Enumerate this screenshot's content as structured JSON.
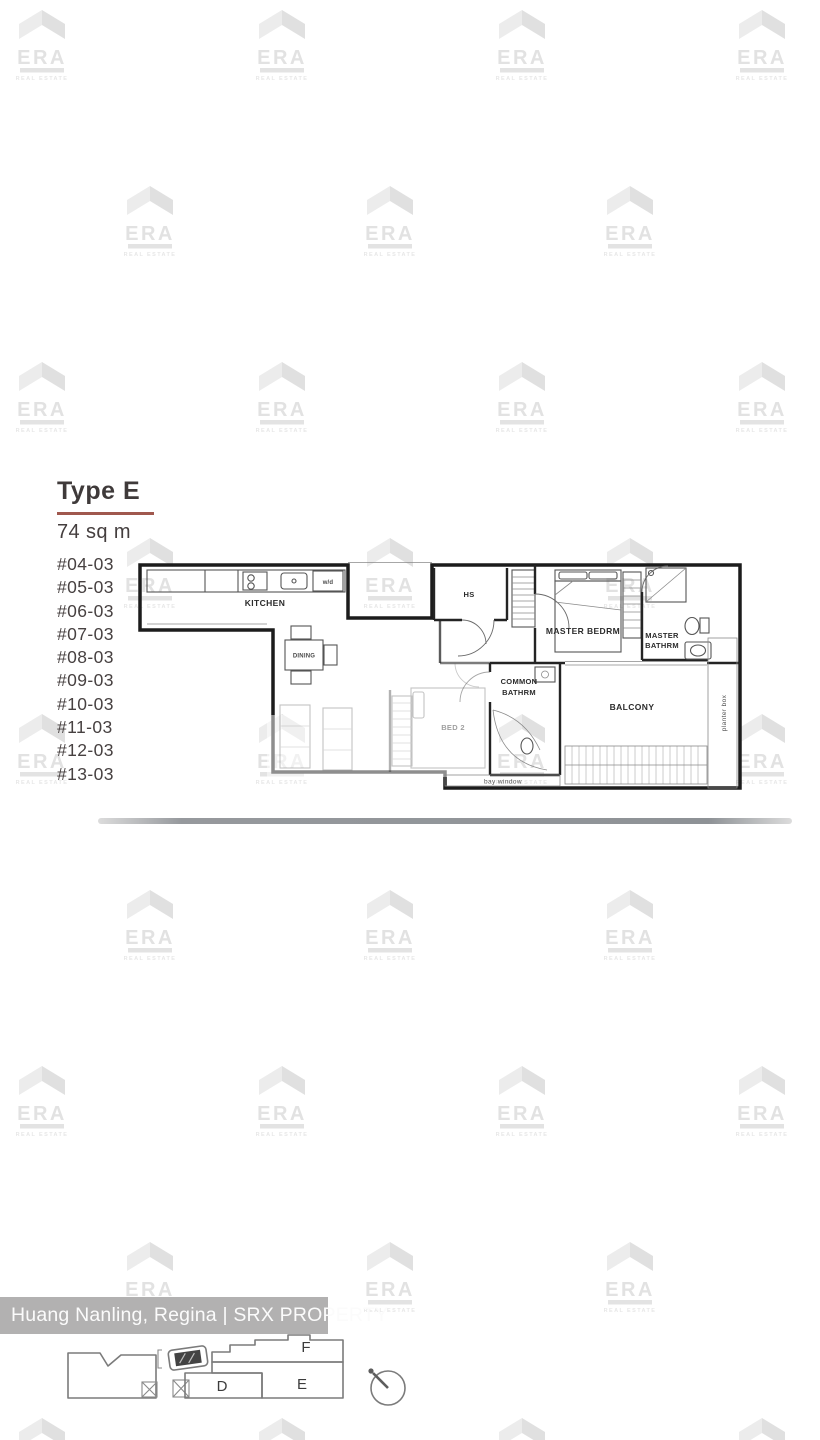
{
  "header": {
    "type_label": "Type E",
    "area": "74 sq m"
  },
  "units": [
    "#04-03",
    "#05-03",
    "#06-03",
    "#07-03",
    "#08-03",
    "#09-03",
    "#10-03",
    "#11-03",
    "#12-03",
    "#13-03"
  ],
  "floor_plan": {
    "labels": {
      "kitchen": "KITCHEN",
      "dining": "DINING",
      "household_shelter": "HS",
      "master_bedroom": "MASTER BEDRM",
      "master_bathroom_line1": "MASTER",
      "master_bathroom_line2": "BATHRM",
      "common_bathroom_line1": "COMMON",
      "common_bathroom_line2": "BATHRM",
      "balcony": "BALCONY",
      "bedroom2": "BED 2",
      "planter_box": "planter box",
      "bay_window": "bay window",
      "washer_dryer": "w/d"
    }
  },
  "watermark": {
    "brand": "ERA",
    "subtext": "REAL ESTATE"
  },
  "attribution": {
    "text": "Huang Nanling, Regina | SRX PROPERTY"
  },
  "site_plan": {
    "block_d": "D",
    "block_e": "E",
    "block_f": "F",
    "compass_direction": "north-west"
  },
  "colors": {
    "accent_underline": "#a0584e",
    "heading_text": "#3f3a3a",
    "attribution_bg": "#b2b1b1",
    "watermark_gray": "#e4e4e4"
  }
}
